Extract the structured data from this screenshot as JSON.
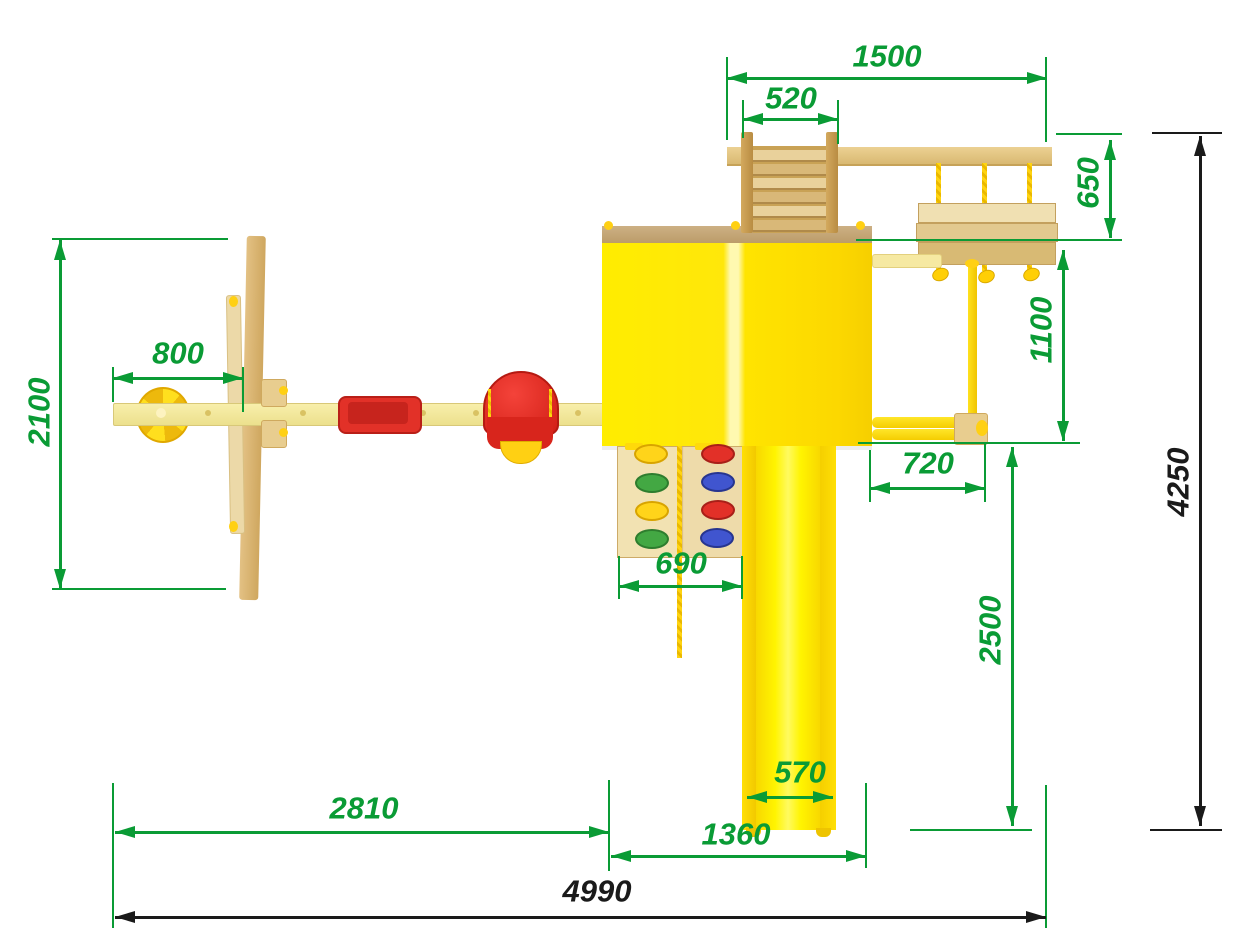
{
  "drawing_title": "Playground set — top view dimensional drawing",
  "units": "mm",
  "colors": {
    "dimension_green": "#0a9b35",
    "dimension_black": "#1a1a1a",
    "tower_yellow": "#ffe400",
    "slide_yellow": "#fff400",
    "wood_tan": "#d9b972",
    "seat_red": "#e23128",
    "background": "#ffffff"
  },
  "measurements": {
    "top_module_length": "1500",
    "ladder_width": "520",
    "rope_bridge_depth": "650",
    "left_bay_depth": "2100",
    "beam_end_to_frame": "800",
    "side_bay_depth": "1100",
    "overall_depth": "4250",
    "rings_bay_width": "720",
    "climbing_wall_width": "690",
    "slide_run_depth": "2500",
    "beam_to_tower": "2810",
    "slide_chute_width": "570",
    "tower_width": "1360",
    "overall_length": "4990"
  },
  "dimensions": [
    {
      "id": "dim-1500",
      "value": "1500",
      "o": "h",
      "y": 78,
      "x1": 727,
      "x2": 1047,
      "lx": 887,
      "ly": 56,
      "c": "green",
      "rot": false
    },
    {
      "id": "dim-520",
      "value": "520",
      "o": "h",
      "y": 119,
      "x1": 743,
      "x2": 838,
      "lx": 791,
      "ly": 98,
      "c": "green",
      "rot": false
    },
    {
      "id": "dim-800",
      "value": "800",
      "o": "h",
      "y": 378,
      "x1": 113,
      "x2": 243,
      "lx": 178,
      "ly": 353,
      "c": "green",
      "rot": false
    },
    {
      "id": "dim-720",
      "value": "720",
      "o": "h",
      "y": 488,
      "x1": 870,
      "x2": 985,
      "lx": 928,
      "ly": 463,
      "c": "green",
      "rot": false
    },
    {
      "id": "dim-690",
      "value": "690",
      "o": "h",
      "y": 586,
      "x1": 619,
      "x2": 742,
      "lx": 681,
      "ly": 563,
      "c": "green",
      "rot": false
    },
    {
      "id": "dim-570",
      "value": "570",
      "o": "h",
      "y": 797,
      "x1": 747,
      "x2": 833,
      "lx": 800,
      "ly": 772,
      "c": "green",
      "rot": false
    },
    {
      "id": "dim-2810",
      "value": "2810",
      "o": "h",
      "y": 832,
      "x1": 115,
      "x2": 609,
      "lx": 364,
      "ly": 808,
      "c": "green",
      "rot": false
    },
    {
      "id": "dim-1360",
      "value": "1360",
      "o": "h",
      "y": 856,
      "x1": 611,
      "x2": 866,
      "lx": 736,
      "ly": 834,
      "c": "green",
      "rot": false
    },
    {
      "id": "dim-4990",
      "value": "4990",
      "o": "h",
      "y": 917,
      "x1": 115,
      "x2": 1046,
      "lx": 597,
      "ly": 891,
      "c": "black",
      "rot": false
    },
    {
      "id": "dim-2100",
      "value": "2100",
      "o": "v",
      "x": 60,
      "y1": 240,
      "y2": 589,
      "lx": 39,
      "ly": 412,
      "c": "green",
      "rot": true
    },
    {
      "id": "dim-650",
      "value": "650",
      "o": "v",
      "x": 1110,
      "y1": 140,
      "y2": 238,
      "lx": 1088,
      "ly": 183,
      "c": "green",
      "rot": true
    },
    {
      "id": "dim-1100",
      "value": "1100",
      "o": "v",
      "x": 1063,
      "y1": 250,
      "y2": 441,
      "lx": 1041,
      "ly": 330,
      "c": "green",
      "rot": true
    },
    {
      "id": "dim-2500",
      "value": "2500",
      "o": "v",
      "x": 1012,
      "y1": 447,
      "y2": 826,
      "lx": 990,
      "ly": 630,
      "c": "green",
      "rot": true
    },
    {
      "id": "dim-4250",
      "value": "4250",
      "o": "v",
      "x": 1200,
      "y1": 136,
      "y2": 826,
      "lx": 1178,
      "ly": 482,
      "c": "black",
      "rot": true
    }
  ],
  "extension_lines": [
    {
      "o": "v",
      "x": 727,
      "y1": 57,
      "y2": 140,
      "c": "green"
    },
    {
      "o": "v",
      "x": 1046,
      "y1": 57,
      "y2": 142,
      "c": "green"
    },
    {
      "o": "v",
      "x": 743,
      "y1": 100,
      "y2": 138,
      "c": "green"
    },
    {
      "o": "v",
      "x": 838,
      "y1": 100,
      "y2": 144,
      "c": "green"
    },
    {
      "o": "h",
      "y": 134,
      "x1": 1056,
      "x2": 1122,
      "c": "green"
    },
    {
      "o": "h",
      "y": 240,
      "x1": 856,
      "x2": 1122,
      "c": "green"
    },
    {
      "o": "h",
      "y": 443,
      "x1": 858,
      "x2": 1080,
      "c": "green"
    },
    {
      "o": "h",
      "y": 830,
      "x1": 910,
      "x2": 1032,
      "c": "green"
    },
    {
      "o": "h",
      "y": 239,
      "x1": 52,
      "x2": 228,
      "c": "green"
    },
    {
      "o": "h",
      "y": 589,
      "x1": 52,
      "x2": 226,
      "c": "green"
    },
    {
      "o": "v",
      "x": 113,
      "y1": 367,
      "y2": 402,
      "c": "green"
    },
    {
      "o": "v",
      "x": 243,
      "y1": 367,
      "y2": 412,
      "c": "green"
    },
    {
      "o": "v",
      "x": 870,
      "y1": 450,
      "y2": 502,
      "c": "green"
    },
    {
      "o": "v",
      "x": 985,
      "y1": 444,
      "y2": 502,
      "c": "green"
    },
    {
      "o": "v",
      "x": 619,
      "y1": 556,
      "y2": 599,
      "c": "green"
    },
    {
      "o": "v",
      "x": 742,
      "y1": 556,
      "y2": 599,
      "c": "green"
    },
    {
      "o": "v",
      "x": 113,
      "y1": 783,
      "y2": 928,
      "c": "green"
    },
    {
      "o": "v",
      "x": 609,
      "y1": 780,
      "y2": 871,
      "c": "green"
    },
    {
      "o": "v",
      "x": 866,
      "y1": 783,
      "y2": 868,
      "c": "green"
    },
    {
      "o": "v",
      "x": 1046,
      "y1": 785,
      "y2": 928,
      "c": "green"
    },
    {
      "o": "h",
      "y": 133,
      "x1": 1152,
      "x2": 1222,
      "c": "black"
    },
    {
      "o": "h",
      "y": 830,
      "x1": 1150,
      "x2": 1222,
      "c": "black"
    }
  ],
  "structure": {
    "climbing_wall": {
      "holds": [
        {
          "cx": 649,
          "cy": 452,
          "fill": "#ffd41a",
          "edge": "#d8a400",
          "name": "hold-yellow"
        },
        {
          "cx": 650,
          "cy": 481,
          "fill": "#43a843",
          "edge": "#2e7d2e",
          "name": "hold-green"
        },
        {
          "cx": 650,
          "cy": 509,
          "fill": "#ffd41a",
          "edge": "#d8a400",
          "name": "hold-yellow"
        },
        {
          "cx": 650,
          "cy": 537,
          "fill": "#43a843",
          "edge": "#2e7d2e",
          "name": "hold-green"
        },
        {
          "cx": 716,
          "cy": 452,
          "fill": "#e23028",
          "edge": "#a81f18",
          "name": "hold-red"
        },
        {
          "cx": 716,
          "cy": 480,
          "fill": "#4055cf",
          "edge": "#27358f",
          "name": "hold-blue"
        },
        {
          "cx": 716,
          "cy": 508,
          "fill": "#e23028",
          "edge": "#a81f18",
          "name": "hold-red"
        },
        {
          "cx": 715,
          "cy": 536,
          "fill": "#4055cf",
          "edge": "#27358f",
          "name": "hold-blue"
        }
      ]
    },
    "ladder": {
      "rung_count": 6,
      "rung_top": 150,
      "rung_step": 14
    },
    "rope_bridge": {
      "rope_x": [
        936,
        982,
        1027
      ]
    },
    "swing_beam": {
      "hole_x": [
        205,
        300,
        367,
        420,
        473,
        530,
        575
      ]
    }
  }
}
